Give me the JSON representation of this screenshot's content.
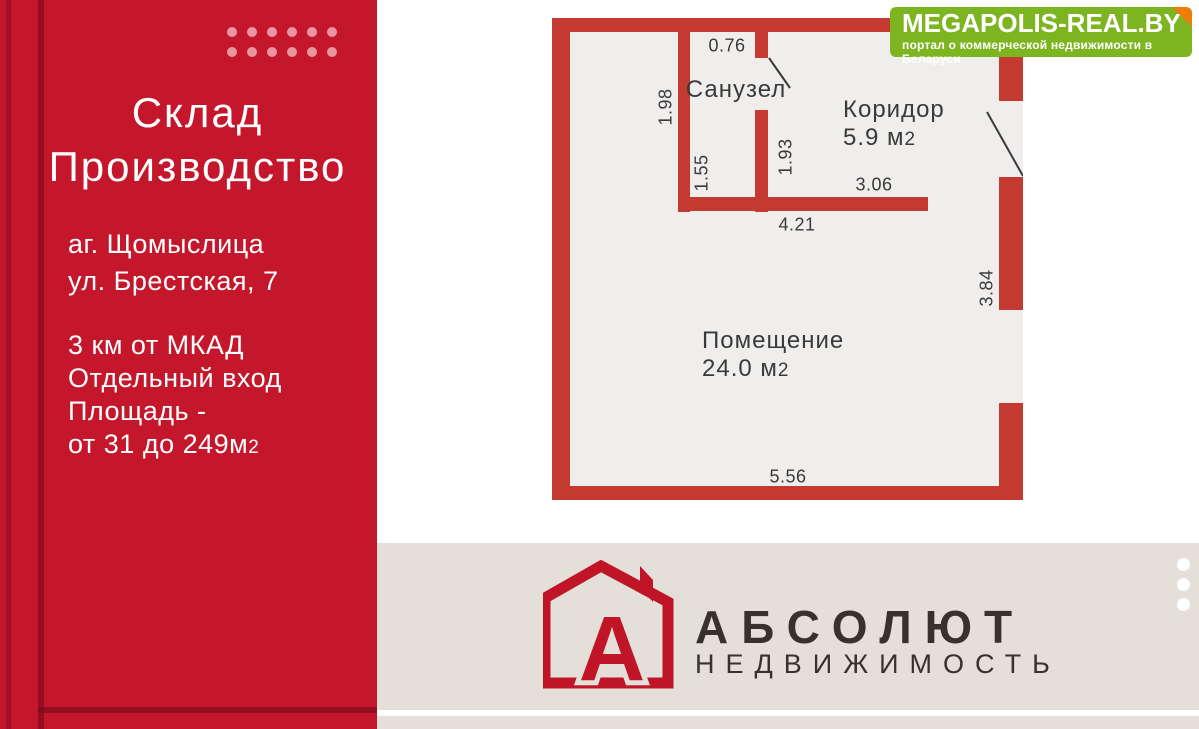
{
  "sidebar": {
    "title_line1": "Склад",
    "title_line2": "Производство",
    "address": [
      "аг. Щомыслица",
      "ул. Брестская, 7"
    ],
    "info": [
      "3 км от МКАД",
      "Отдельный вход",
      "Площадь -"
    ],
    "area_text": "от 31 до 249м",
    "area_sub": "2"
  },
  "megapolis": {
    "title": "MEGAPOLIS-REAL.BY",
    "subtitle": "портал о коммерческой недвижимости в Беларуси"
  },
  "floorplan": {
    "rooms": {
      "sanuzel": {
        "label": "Санузел"
      },
      "koridor": {
        "label": "Коридор",
        "area": "5.9 м",
        "area_sub": "2"
      },
      "pomeshchenie": {
        "label": "Помещение",
        "area": "24.0 м",
        "area_sub": "2"
      }
    },
    "dims": {
      "d076": "0.76",
      "d198": "1.98",
      "d155": "1.55",
      "d193": "1.93",
      "d306": "3.06",
      "d421": "4.21",
      "d384": "3.84",
      "d556": "5.56"
    }
  },
  "footer": {
    "brand": "АБСОЛЮТ",
    "brand_sub": "НЕДВИЖИМОСТЬ",
    "logo_letter": "А"
  },
  "colors": {
    "panel_red": "#c5172b",
    "panel_dark": "#7f0c1c",
    "dot_pink": "#f0abb4",
    "wall_red": "#c43a30",
    "plan_bg": "#f0eeec",
    "label_dark": "#3a3a3a",
    "banner_green": "#7cb520",
    "fold_orange": "#ef7d05",
    "footer_beige": "#e4dfd9",
    "brand_dark": "#37322e",
    "house_red": "#c01527"
  }
}
